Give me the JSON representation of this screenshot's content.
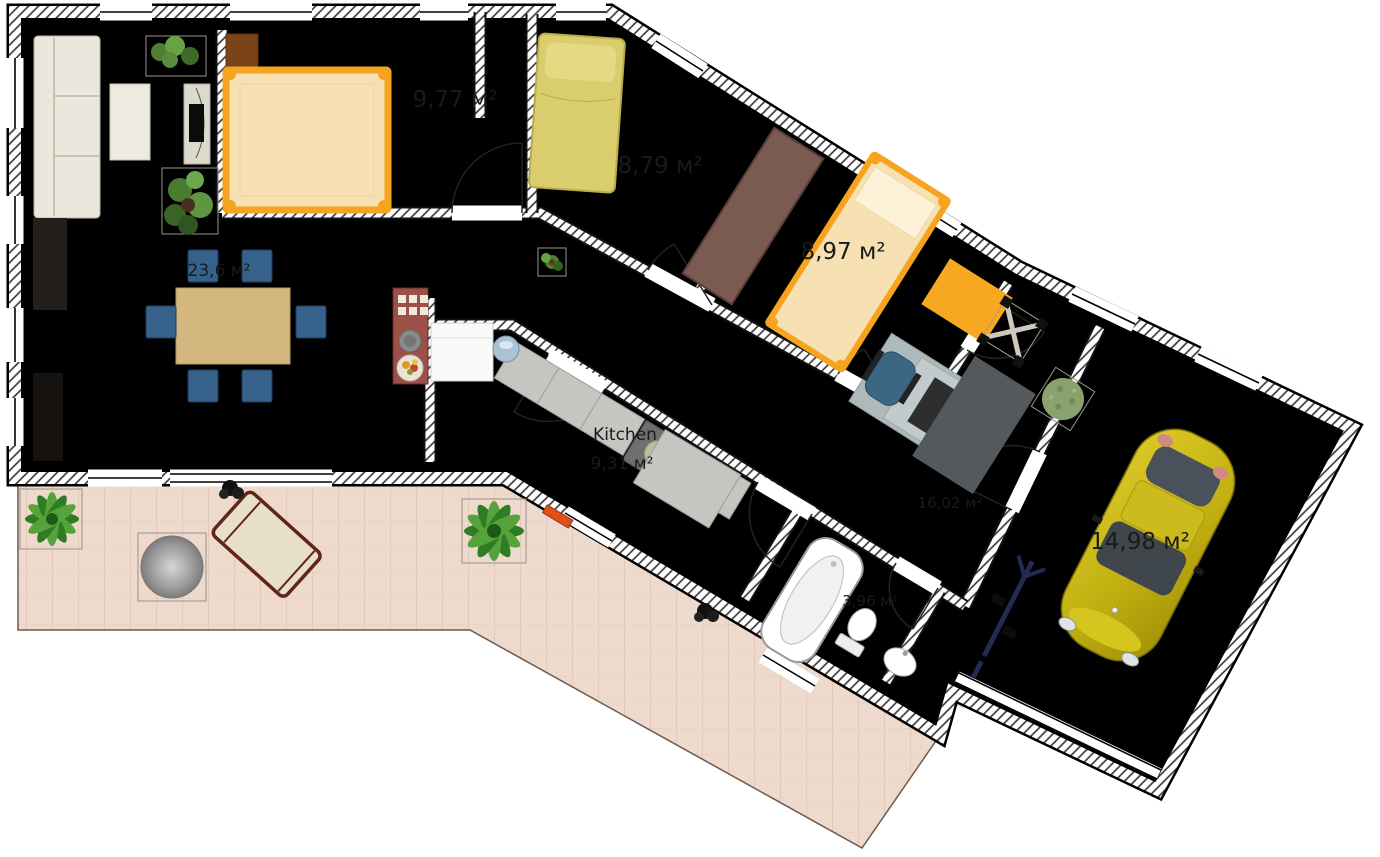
{
  "page": {
    "title": "Floor plan"
  },
  "plan": {
    "unit": "м²",
    "rooms": [
      {
        "id": "bedroom-1",
        "label": "9,77 м²"
      },
      {
        "id": "bedroom-2",
        "label": "8,79 м²"
      },
      {
        "id": "bedroom-3",
        "label": "8,97 м²"
      },
      {
        "id": "living-dining-room",
        "label": "23,6 м²"
      },
      {
        "id": "kitchen",
        "name": "Kitchen",
        "label": "9,31 м²"
      },
      {
        "id": "hallway",
        "label": "16,02 м²"
      },
      {
        "id": "bathroom",
        "label": "3,96 м²"
      },
      {
        "id": "garage",
        "label": "14,98 м²"
      }
    ],
    "colors": {
      "bed_accent_orange": "#f6a41f",
      "car_yellow": "#c9b416",
      "chair_blue": "#35618a",
      "wood_floor": "#c7b6a4",
      "carpet_gray": "#dcdcdc",
      "terrace_tile": "#eedacd",
      "bath_tile_blue": "#92b7c0"
    },
    "furniture": [
      "corner sofa",
      "coffee table",
      "tv stand",
      "houseplants",
      "dining table",
      "6 chairs",
      "double bed",
      "single beds",
      "wardrobe",
      "desk with office chair",
      "kitchen counter",
      "cooktop",
      "washing machine",
      "sink",
      "bathtub",
      "toilet",
      "washbasin",
      "car",
      "bicycle",
      "garden table",
      "lounge chair",
      "palm plants"
    ]
  }
}
